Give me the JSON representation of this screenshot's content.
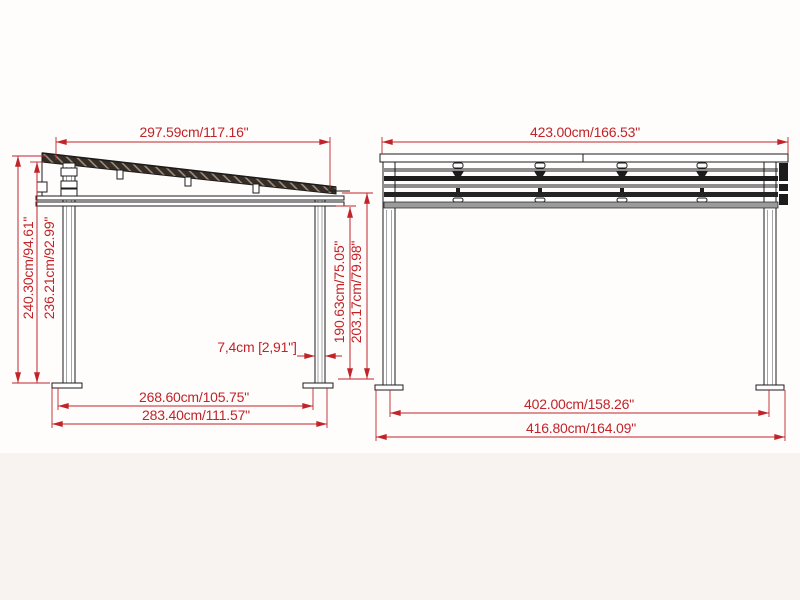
{
  "page": {
    "background_color": "#fffdfc",
    "footer_band_color": "#f8f3f0"
  },
  "drawing": {
    "type": "pergola-dimensional-drawing",
    "dimension_color": "#c02429",
    "line_color": "#1c1c1c",
    "side_view": {
      "name": "side elevation",
      "dim_roof_width": "297.59cm/117.16\"",
      "dim_height_back_outer": "240.30cm/94.61\"",
      "dim_height_back_inner": "236.21cm/92.99\"",
      "dim_post_width": "7,4cm [2,91\"]",
      "dim_height_front_inner": "190.63cm/75.05\"",
      "dim_height_front_outer": "203.17cm/79.98\"",
      "dim_span_inner": "268.60cm/105.75\"",
      "dim_span_outer": "283.40cm/111.57\""
    },
    "front_view": {
      "name": "front elevation",
      "dim_roof_width": "423.00cm/166.53\"",
      "dim_span_inner": "402.00cm/158.26\"",
      "dim_span_outer": "416.80cm/164.09\""
    }
  }
}
